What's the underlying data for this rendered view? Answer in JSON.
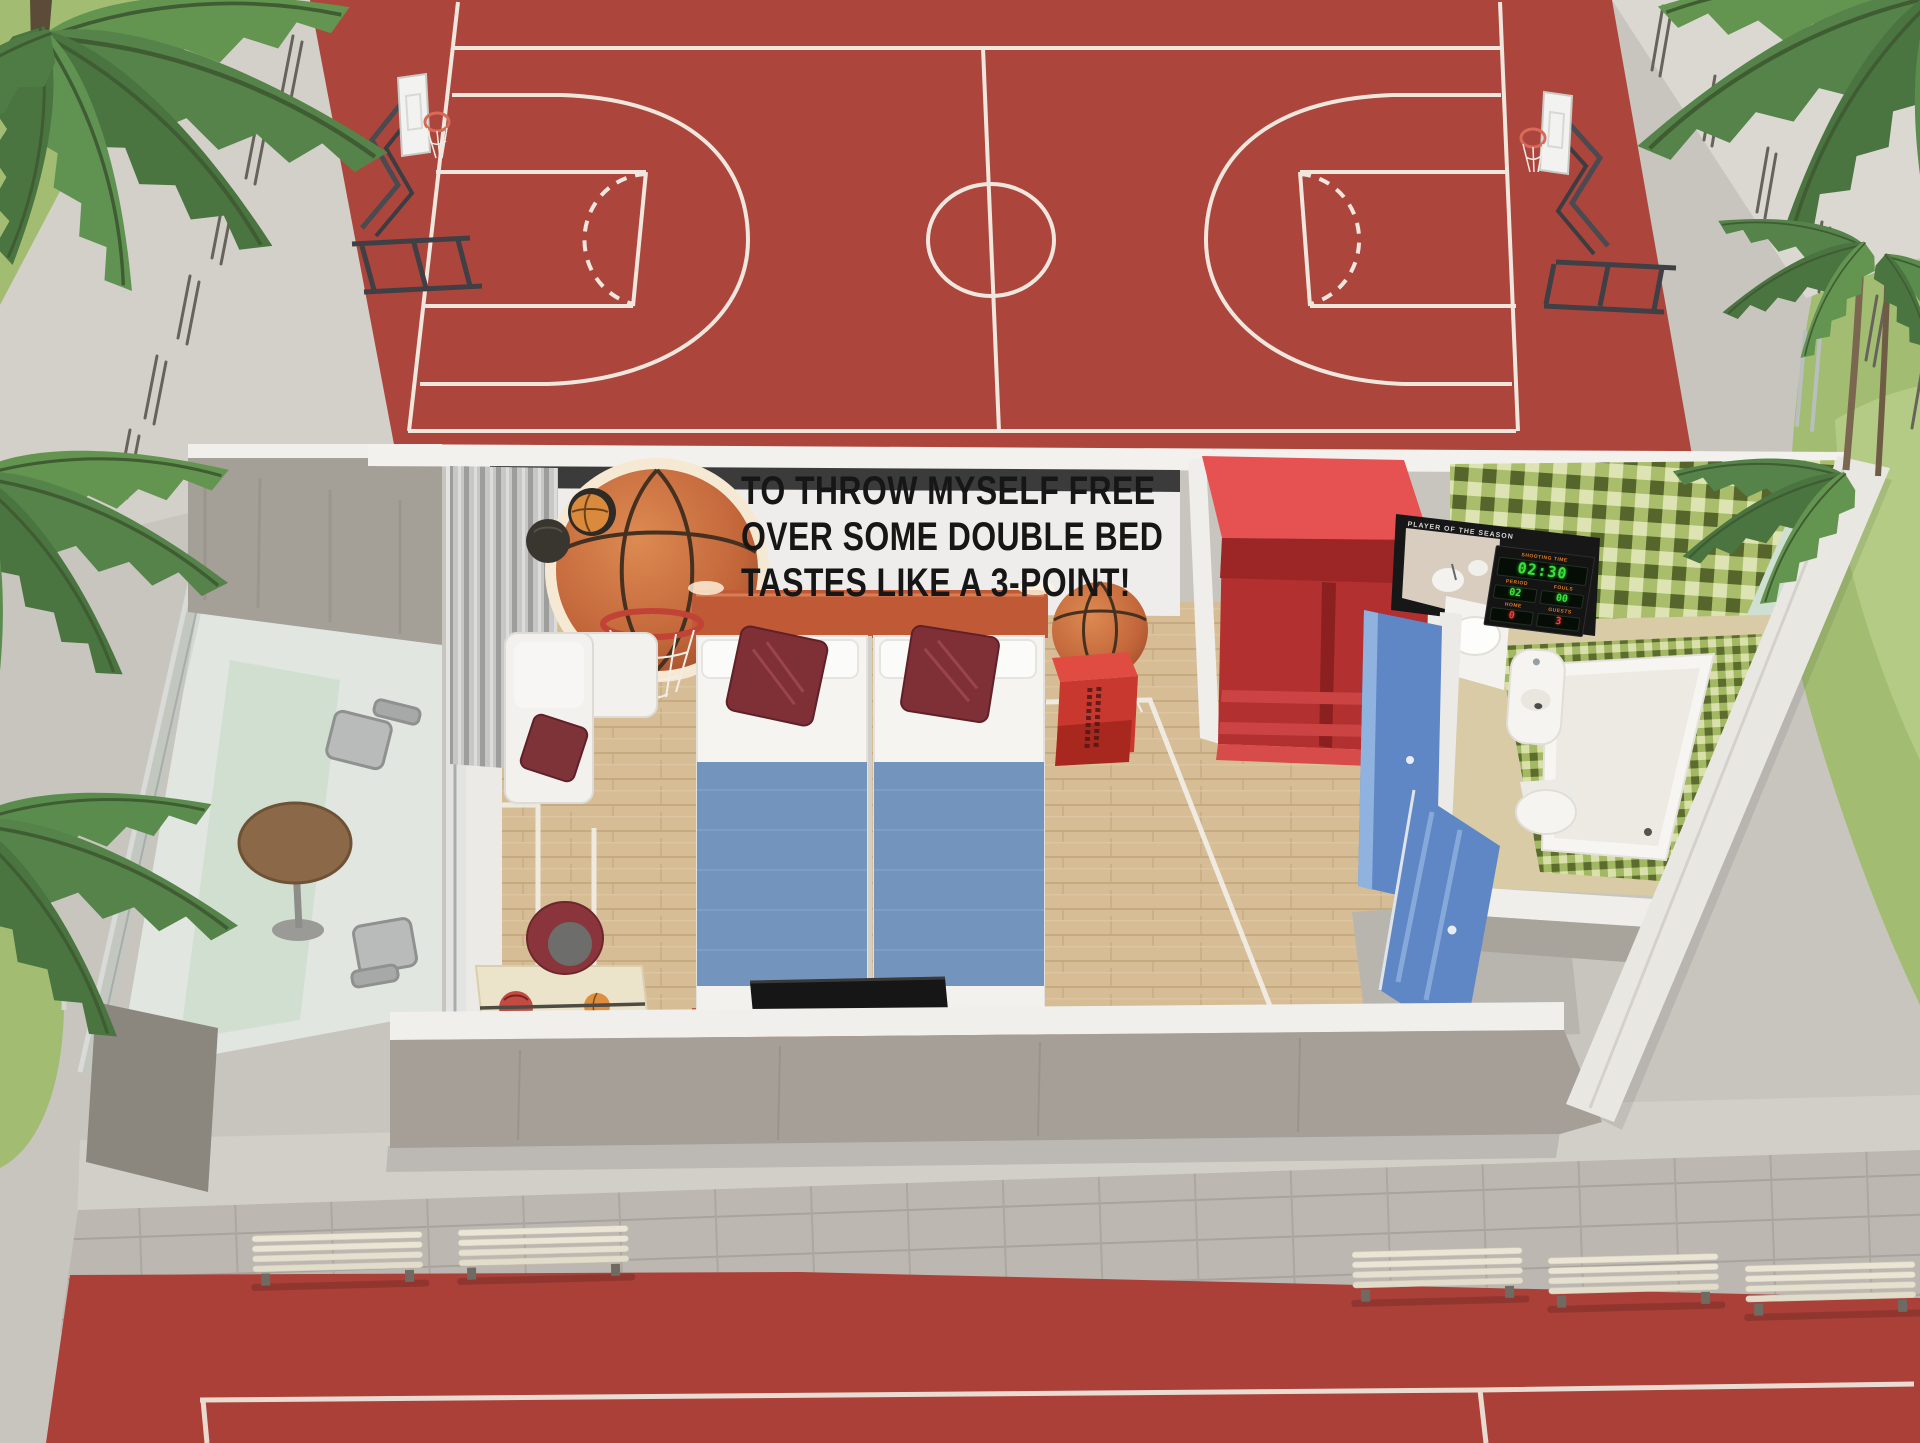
{
  "wall_art_quote": {
    "lines": [
      "TO THROW MYSELF FREE",
      "OVER SOME DOUBLE BED",
      "TASTES LIKE A 3-POINT!"
    ]
  },
  "bathroom_scoreboard": {
    "frame_caption": "PLAYER OF THE SEASON",
    "shot_clock_label": "SHOOTING TIME",
    "shot_clock_value": "02:30",
    "period_label": "PERIOD",
    "period_value": "02",
    "fouls_label": "FOULS",
    "fouls_value": "00",
    "home_label": "HOME",
    "home_value": "0",
    "guests_label": "GUESTS",
    "guests_value": "3"
  },
  "palette": {
    "court_red": "#ac463c",
    "court_line_white": "#f3efe7",
    "pavement_gray": "#c8c5bf",
    "grass_green": "#a2bd72",
    "palm_green": "#55834a",
    "room_wall_white": "#f0efec",
    "concrete_gray": "#a59f97",
    "wood_floor": "#d7bd95",
    "bed_runner_blue": "#7395bd",
    "pillow_maroon": "#7e3036",
    "headboard_orange": "#c05a36",
    "wardrobe_red": "#d84343",
    "door_blue": "#5f87c6",
    "bath_tile_green": "#a9bd6b",
    "scoreboard_green": "#3ae23a",
    "scoreboard_red": "#f04040"
  }
}
